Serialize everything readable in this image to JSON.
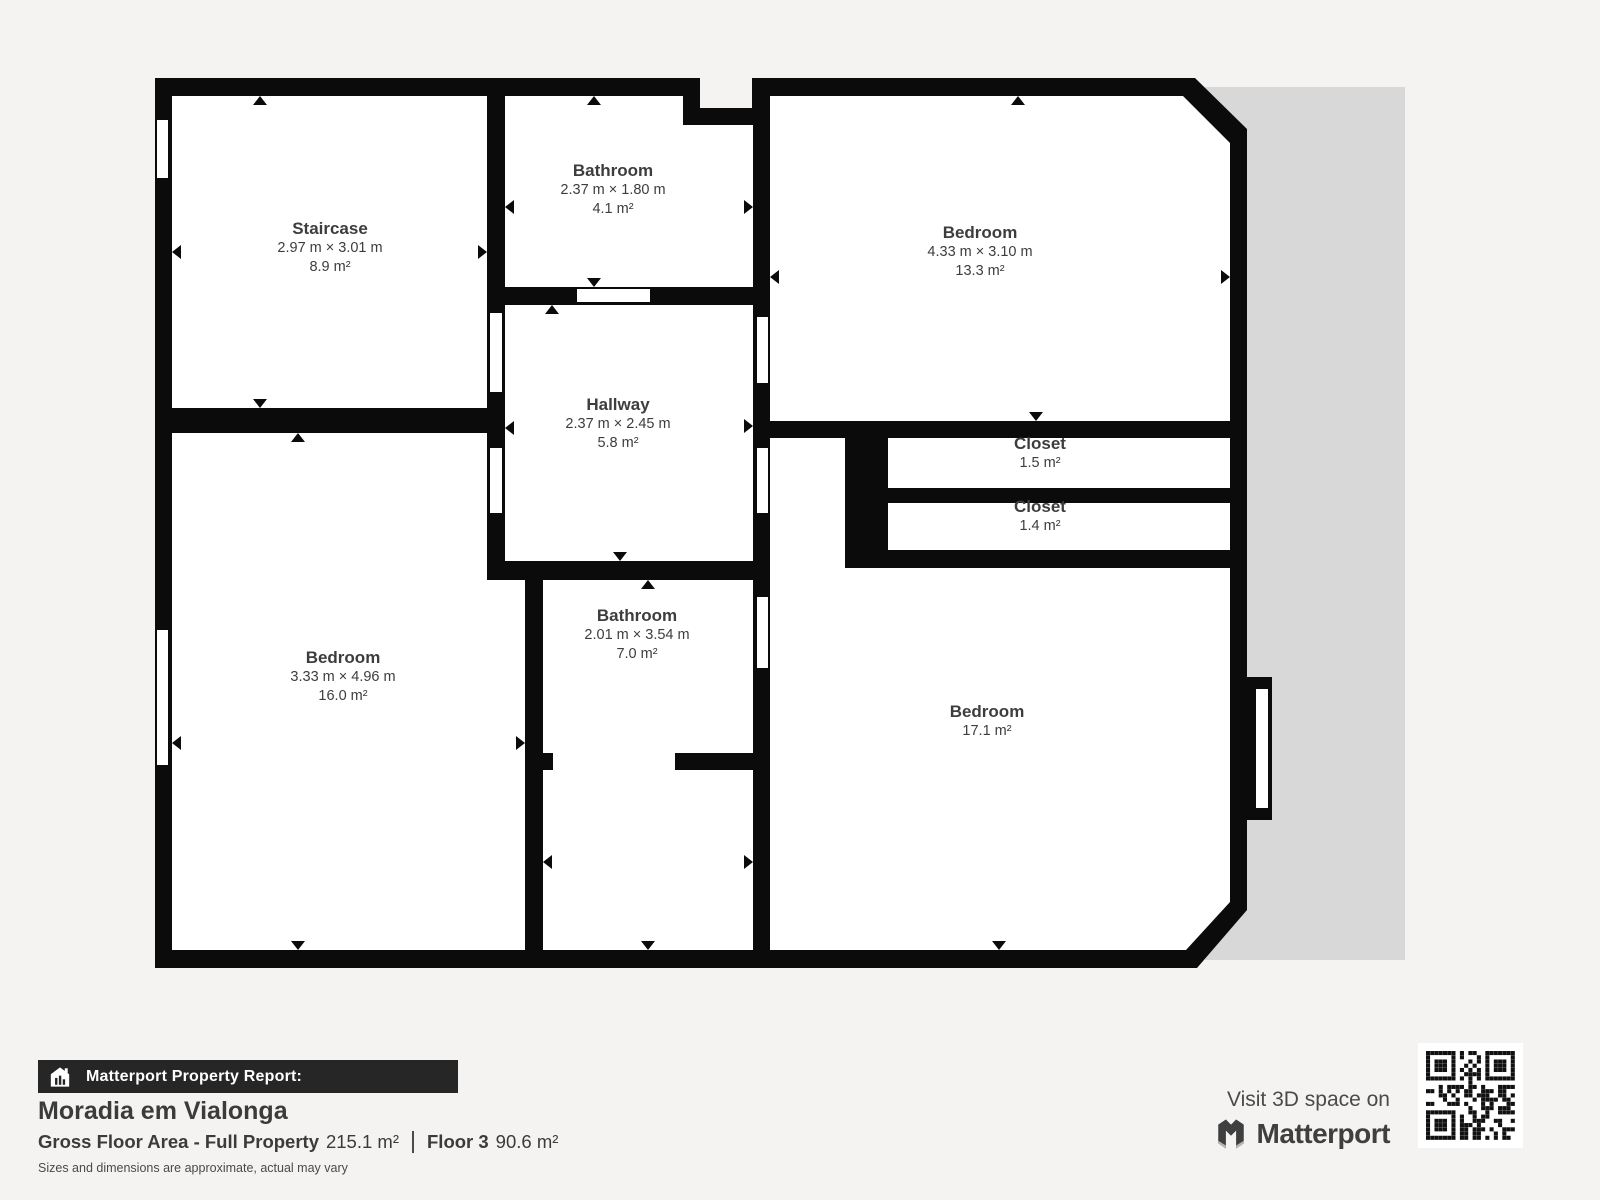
{
  "floorplan": {
    "wall_color": "#0b0b0b",
    "room_fill": "#ffffff",
    "shadow_color": "#d8d8d8",
    "background": "#f4f3f1",
    "rooms": [
      {
        "id": "staircase",
        "name": "Staircase",
        "dimensions": "2.97 m × 3.01 m",
        "area": "8.9 m²"
      },
      {
        "id": "bathroom-top",
        "name": "Bathroom",
        "dimensions": "2.37 m × 1.80 m",
        "area": "4.1 m²"
      },
      {
        "id": "bedroom-top-right",
        "name": "Bedroom",
        "dimensions": "4.33 m × 3.10 m",
        "area": "13.3 m²"
      },
      {
        "id": "hallway",
        "name": "Hallway",
        "dimensions": "2.37 m × 2.45 m",
        "area": "5.8 m²"
      },
      {
        "id": "closet-1",
        "name": "Closet",
        "dimensions": "",
        "area": "1.5 m²"
      },
      {
        "id": "closet-2",
        "name": "Closet",
        "dimensions": "",
        "area": "1.4 m²"
      },
      {
        "id": "bedroom-bottom-left",
        "name": "Bedroom",
        "dimensions": "3.33 m × 4.96 m",
        "area": "16.0 m²"
      },
      {
        "id": "bathroom-bottom",
        "name": "Bathroom",
        "dimensions": "2.01 m × 3.54 m",
        "area": "7.0 m²"
      },
      {
        "id": "bedroom-bottom-right",
        "name": "Bedroom",
        "dimensions": "",
        "area": "17.1 m²"
      }
    ]
  },
  "footer": {
    "report_label": "Matterport Property Report:",
    "property_name": "Moradia em Vialonga",
    "gfa_label": "Gross Floor Area - Full Property",
    "gfa_value": "215.1 m²",
    "floor_label": "Floor 3",
    "floor_value": "90.6 m²",
    "disclaimer": "Sizes and dimensions are approximate, actual may vary"
  },
  "branding": {
    "visit_text": "Visit 3D space on",
    "brand_name": "Matterport"
  }
}
